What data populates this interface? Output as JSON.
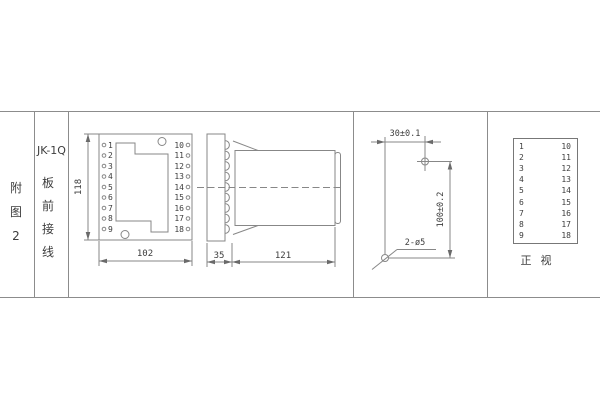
{
  "page": {
    "background": "#ffffff",
    "line_color": "#8c8c8c",
    "text_color": "#3d3d3d"
  },
  "sidebar": {
    "figure_chars": [
      "附",
      "图",
      "2"
    ],
    "model": "JK-1Q",
    "wiring_chars": [
      "板",
      "前",
      "接",
      "线"
    ]
  },
  "front_view": {
    "dim_height": "118",
    "dim_width": "102",
    "left_terminals": [
      "1",
      "2",
      "3",
      "4",
      "5",
      "6",
      "7",
      "8",
      "9"
    ],
    "right_terminals": [
      "10",
      "11",
      "12",
      "13",
      "14",
      "15",
      "16",
      "17",
      "18"
    ]
  },
  "side_view": {
    "dim_plate": "35",
    "dim_body": "121"
  },
  "drill_view": {
    "dim_horizontal": "30±0.1",
    "dim_vertical": "100±0.2",
    "hole_label": "2-ø5"
  },
  "terminal_table": {
    "rows": [
      {
        "left": "1",
        "right": "10"
      },
      {
        "left": "2",
        "right": "11"
      },
      {
        "left": "3",
        "right": "12"
      },
      {
        "left": "4",
        "right": "13"
      },
      {
        "left": "5",
        "right": "14"
      },
      {
        "left": "6",
        "right": "15"
      },
      {
        "left": "7",
        "right": "16"
      },
      {
        "left": "8",
        "right": "17"
      },
      {
        "left": "9",
        "right": "18"
      }
    ],
    "caption_c1": "正",
    "caption_c2": "视"
  }
}
